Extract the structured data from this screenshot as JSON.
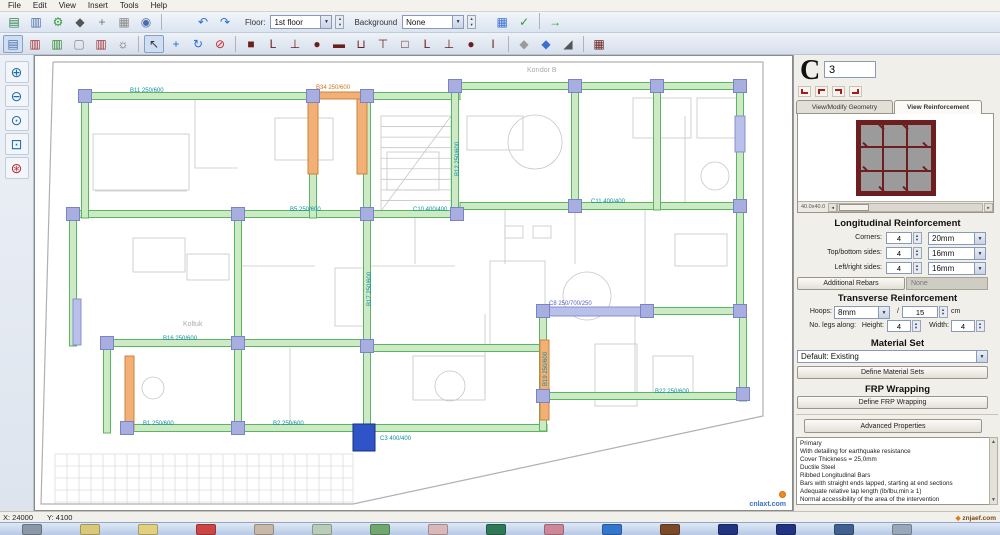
{
  "menu": {
    "items": [
      "File",
      "Edit",
      "View",
      "Insert",
      "Tools",
      "Help"
    ]
  },
  "toolbar": {
    "floor_label": "Floor:",
    "floor_value": "1st floor",
    "background_label": "Background",
    "background_value": "None",
    "row1_left": [
      {
        "name": "save-icon",
        "glyph": "▤",
        "color": "#2d7d46"
      },
      {
        "name": "export-icon",
        "glyph": "▥",
        "color": "#4a6da8"
      },
      {
        "name": "settings-gear-icon",
        "glyph": "⚙",
        "color": "#3a9a3a"
      },
      {
        "name": "3d-view-icon",
        "glyph": "◆",
        "color": "#555555"
      },
      {
        "name": "snap-axes-icon",
        "glyph": "+",
        "color": "#777777"
      },
      {
        "name": "print-icon",
        "glyph": "▦",
        "color": "#888888"
      },
      {
        "name": "print-preview-icon",
        "glyph": "◉",
        "color": "#4a6da8"
      }
    ],
    "row1_undo": [
      {
        "name": "undo-icon",
        "glyph": "↶",
        "color": "#2b6cd4"
      },
      {
        "name": "redo-icon",
        "glyph": "↷",
        "color": "#2b6cd4"
      }
    ],
    "row1_right": [
      {
        "name": "tables-icon",
        "glyph": "▦",
        "color": "#3b6fd4"
      },
      {
        "name": "checks-icon",
        "glyph": "✓",
        "color": "#2d9a2d"
      },
      {
        "sep": true
      },
      {
        "name": "run-icon",
        "glyph": "→",
        "color": "#2d9a2d"
      }
    ],
    "row2": [
      {
        "name": "insert-column-tool",
        "glyph": "▤",
        "color": "#4a6da8",
        "pressed": true
      },
      {
        "name": "insert-beam-tool",
        "glyph": "▥",
        "color": "#a03030"
      },
      {
        "name": "insert-wall-tool",
        "glyph": "▥",
        "color": "#2d8a2d"
      },
      {
        "name": "insert-slab-tool",
        "glyph": "▢",
        "color": "#888888"
      },
      {
        "name": "insert-stair-tool",
        "glyph": "▥",
        "color": "#a03030"
      },
      {
        "name": "pattern-tool",
        "glyph": "☼",
        "color": "#555555"
      },
      {
        "sep": true
      },
      {
        "name": "select-tool",
        "glyph": "↖",
        "color": "#333333",
        "pressed": true
      },
      {
        "name": "move-tool",
        "glyph": "+",
        "color": "#2b6cd4"
      },
      {
        "name": "rotate-tool",
        "glyph": "↻",
        "color": "#2b6cd4"
      },
      {
        "name": "delete-tool",
        "glyph": "⊘",
        "color": "#cc2222"
      },
      {
        "sep": true
      },
      {
        "name": "section-square-icon",
        "glyph": "■",
        "color": "#6b2020"
      },
      {
        "name": "section-L-icon",
        "glyph": "L",
        "color": "#6b2020"
      },
      {
        "name": "section-T-footing-icon",
        "glyph": "⊥",
        "color": "#6b2020"
      },
      {
        "name": "section-circle-icon",
        "glyph": "●",
        "color": "#6b2020"
      },
      {
        "name": "section-wall-icon",
        "glyph": "▬",
        "color": "#6b2020"
      },
      {
        "name": "section-U-icon",
        "glyph": "⊔",
        "color": "#6b2020"
      },
      {
        "name": "section-Tbeam-icon",
        "glyph": "⊤",
        "color": "#6b2020"
      },
      {
        "name": "section-box-icon",
        "glyph": "□",
        "color": "#6b2020"
      },
      {
        "name": "section-L2-icon",
        "glyph": "L",
        "color": "#6b2020"
      },
      {
        "name": "section-T2-icon",
        "glyph": "⊥",
        "color": "#6b2020"
      },
      {
        "name": "section-octagon-icon",
        "glyph": "●",
        "color": "#6b2020"
      },
      {
        "name": "section-column-icon",
        "glyph": "I",
        "color": "#6b2020"
      },
      {
        "sep": true
      },
      {
        "name": "slab-flat-icon",
        "glyph": "◆",
        "color": "#9a9a9a"
      },
      {
        "name": "slab-inclined-icon",
        "glyph": "◆",
        "color": "#3b6fd4"
      },
      {
        "name": "ramp-icon",
        "glyph": "◢",
        "color": "#555555"
      },
      {
        "sep": true
      },
      {
        "name": "building-modeller-icon",
        "glyph": "▦",
        "color": "#6b2020"
      }
    ],
    "side": [
      {
        "name": "zoom-in-icon",
        "glyph": "⊕",
        "color": "#1f6fa8"
      },
      {
        "name": "zoom-out-icon",
        "glyph": "⊖",
        "color": "#1f6fa8"
      },
      {
        "name": "zoom-actual-icon",
        "glyph": "⊙",
        "color": "#1f6fa8"
      },
      {
        "name": "zoom-window-icon",
        "glyph": "⊡",
        "color": "#1f6fa8"
      },
      {
        "name": "zoom-extents-icon",
        "glyph": "⊛",
        "color": "#b33333"
      }
    ]
  },
  "plan": {
    "colors": {
      "beam_fill": "#cdeac6",
      "beam_stroke": "#5bb55b",
      "column_fill": "#a9aee0",
      "column_stroke": "#7b82c6",
      "wall_orange": "#f2b077",
      "wall_orange_stroke": "#c9853e",
      "wall_blue": "#b9c0ea",
      "wall_blue_stroke": "#8890cc",
      "selected": "#2e54c8",
      "label_teal": "#0b8fa0",
      "label_orange": "#d0761c",
      "label_blue": "#5560c4",
      "bg_stroke": "#c6c6c6",
      "boundary_stroke": "#b0b0b0",
      "tile_stroke": "#dcdcdc",
      "room_label": "#aaaaaa"
    },
    "beams_h": [
      [
        50,
        40,
        230
      ],
      [
        332,
        40,
        93
      ],
      [
        420,
        30,
        288
      ],
      [
        38,
        158,
        390
      ],
      [
        425,
        150,
        285
      ],
      [
        72,
        287,
        265
      ],
      [
        335,
        292,
        173
      ],
      [
        612,
        255,
        98
      ],
      [
        92,
        372,
        420
      ],
      [
        508,
        340,
        202
      ]
    ],
    "beams_v": [
      [
        50,
        40,
        122
      ],
      [
        38,
        158,
        132
      ],
      [
        72,
        287,
        90
      ],
      [
        203,
        158,
        218
      ],
      [
        278,
        40,
        122
      ],
      [
        332,
        40,
        336
      ],
      [
        420,
        30,
        132
      ],
      [
        508,
        255,
        120
      ],
      [
        540,
        30,
        124
      ],
      [
        622,
        30,
        124
      ],
      [
        705,
        30,
        230
      ],
      [
        708,
        255,
        90
      ]
    ],
    "walls_orange": [
      [
        273,
        36,
        10,
        82
      ],
      [
        322,
        36,
        10,
        82
      ],
      [
        273,
        36,
        59,
        7
      ],
      [
        90,
        300,
        9,
        74
      ],
      [
        505,
        284,
        9,
        80
      ]
    ],
    "walls_blue": [
      [
        508,
        251,
        104,
        9
      ],
      [
        38,
        243,
        8,
        46
      ],
      [
        700,
        60,
        10,
        36
      ]
    ],
    "columns": [
      [
        50,
        40
      ],
      [
        278,
        40
      ],
      [
        332,
        40
      ],
      [
        420,
        30
      ],
      [
        540,
        30
      ],
      [
        622,
        30
      ],
      [
        705,
        30
      ],
      [
        38,
        158
      ],
      [
        203,
        158
      ],
      [
        332,
        158
      ],
      [
        422,
        158
      ],
      [
        540,
        150
      ],
      [
        705,
        150
      ],
      [
        72,
        287
      ],
      [
        203,
        287
      ],
      [
        332,
        290
      ],
      [
        508,
        255
      ],
      [
        612,
        255
      ],
      [
        705,
        255
      ],
      [
        92,
        372
      ],
      [
        203,
        372
      ],
      [
        508,
        340
      ],
      [
        708,
        338
      ]
    ],
    "selected_column": [
      318,
      368,
      22,
      27
    ],
    "labels": [
      [
        95,
        36,
        "B11  250/600",
        "teal"
      ],
      [
        281,
        33,
        "B34  250/600",
        "orange"
      ],
      [
        255,
        155,
        "B5  250/600",
        "teal"
      ],
      [
        378,
        155,
        "C10  400/400",
        "teal"
      ],
      [
        556,
        147,
        "C11  400/400",
        "teal"
      ],
      [
        128,
        284,
        "B16  250/600",
        "teal"
      ],
      [
        108,
        369,
        "B1  250/600",
        "teal"
      ],
      [
        238,
        369,
        "B2  250/600",
        "teal"
      ],
      [
        514,
        249,
        "C8  250/700/250",
        "blue"
      ],
      [
        345,
        384,
        "C3  400/400",
        "teal"
      ],
      [
        620,
        337,
        "B22  250/600",
        "teal"
      ]
    ],
    "vlabels": [
      [
        424,
        120,
        "B12  250/600",
        "teal"
      ],
      [
        336,
        250,
        "B17  250/600",
        "teal"
      ],
      [
        512,
        330,
        "B19  250/600",
        "teal"
      ]
    ],
    "room_labels": [
      [
        148,
        270,
        "Koltuk"
      ],
      [
        492,
        16,
        "Korıdor B"
      ]
    ],
    "bg": {
      "boundary": [
        [
          [
            18,
            6
          ],
          [
            6,
            448
          ],
          [
            318,
            448
          ]
        ],
        [
          [
            318,
            448
          ],
          [
            728,
            360
          ],
          [
            728,
            6
          ],
          [
            18,
            6
          ]
        ]
      ],
      "tiles": [
        20,
        398,
        298,
        50,
        12
      ],
      "stairs": [
        346,
        60,
        70,
        95,
        9
      ],
      "rects": [
        [
          58,
          78,
          96,
          56
        ],
        [
          240,
          62,
          58,
          42
        ],
        [
          352,
          96,
          52,
          38
        ],
        [
          432,
          60,
          56,
          34
        ],
        [
          598,
          42,
          58,
          40
        ],
        [
          662,
          42,
          40,
          40
        ],
        [
          455,
          205,
          55,
          90
        ],
        [
          300,
          212,
          30,
          58
        ],
        [
          98,
          182,
          52,
          34
        ],
        [
          152,
          198,
          42,
          26
        ],
        [
          378,
          300,
          72,
          44
        ],
        [
          560,
          288,
          42,
          62
        ],
        [
          640,
          178,
          52,
          32
        ],
        [
          618,
          300,
          40,
          40
        ],
        [
          470,
          170,
          18,
          12
        ],
        [
          498,
          170,
          18,
          12
        ]
      ],
      "circles": [
        [
          500,
          86,
          27
        ],
        [
          552,
          240,
          24
        ],
        [
          415,
          330,
          15
        ],
        [
          118,
          332,
          11
        ],
        [
          680,
          120,
          14
        ]
      ],
      "lines": [
        [
          160,
          44,
          160,
          112
        ],
        [
          160,
          112,
          203,
          112
        ],
        [
          420,
          34,
          420,
          112
        ],
        [
          470,
          152,
          470,
          208
        ],
        [
          540,
          152,
          540,
          208
        ],
        [
          380,
          162,
          380,
          208
        ],
        [
          610,
          150,
          610,
          252
        ],
        [
          450,
          258,
          450,
          338
        ],
        [
          560,
          152,
          660,
          152
        ],
        [
          255,
          292,
          255,
          368
        ],
        [
          60,
          135,
          152,
          135
        ],
        [
          600,
          258,
          600,
          338
        ],
        [
          650,
          60,
          650,
          148
        ],
        [
          336,
          210,
          420,
          210
        ],
        [
          203,
          210,
          280,
          210
        ]
      ]
    }
  },
  "panel": {
    "section_type": "C",
    "section_id": "3",
    "tabs": {
      "geometry": "View/Modify Geometry",
      "reinforcement": "View Reinforcement"
    },
    "preview_caption": "40.0x40.0",
    "long": {
      "title": "Longitudinal Reinforcement",
      "corners_label": "Corners:",
      "corners_value": "4",
      "corners_dia": "20mm",
      "top_label": "Top/bottom sides:",
      "top_value": "4",
      "top_dia": "16mm",
      "side_label": "Left/right sides:",
      "side_value": "4",
      "side_dia": "16mm",
      "additional_button": "Additional Rebars",
      "additional_value": "None"
    },
    "trans": {
      "title": "Transverse Reinforcement",
      "hoops_label": "Hoops:",
      "hoops_dia": "8mm",
      "slash": "/",
      "spacing": "15",
      "unit": "cm",
      "legs_label": "No. legs along:",
      "height_label": "Height:",
      "height_value": "4",
      "width_label": "Width:",
      "width_value": "4"
    },
    "material": {
      "title": "Material Set",
      "value": "Default: Existing",
      "button": "Define Material Sets"
    },
    "frp": {
      "title": "FRP Wrapping",
      "button": "Define FRP Wrapping"
    },
    "advanced": "Advanced Properties",
    "notes": [
      "Primary",
      "With detailing for earthquake resistance",
      "Cover Thickness = 25,0mm",
      "Ductile Steel",
      "Ribbed Longitudinal Bars",
      "Bars with straight ends lapped, starting at end sections",
      "Adequate relative lap length (lb/lbu,min ≥ 1)",
      "Normal accessibility of the area of the intervention"
    ]
  },
  "statusbar": {
    "x": "X: 24000",
    "y": "Y: 4100"
  },
  "taskbar": {
    "colors": [
      "#8a98a8",
      "#d8c87a",
      "#e0d080",
      "#cc4444",
      "#c8b8a8",
      "#b8ccb8",
      "#6fa86f",
      "#d8b8b8",
      "#2f7858",
      "#cc8899",
      "#3377cc",
      "#7a4a28",
      "#22337f",
      "#22337f",
      "#40608f",
      "#98a8ba"
    ]
  },
  "watermarks": {
    "canvas_domain": "cnlaxt.com",
    "taskbar_domain": "znjaef.com"
  }
}
